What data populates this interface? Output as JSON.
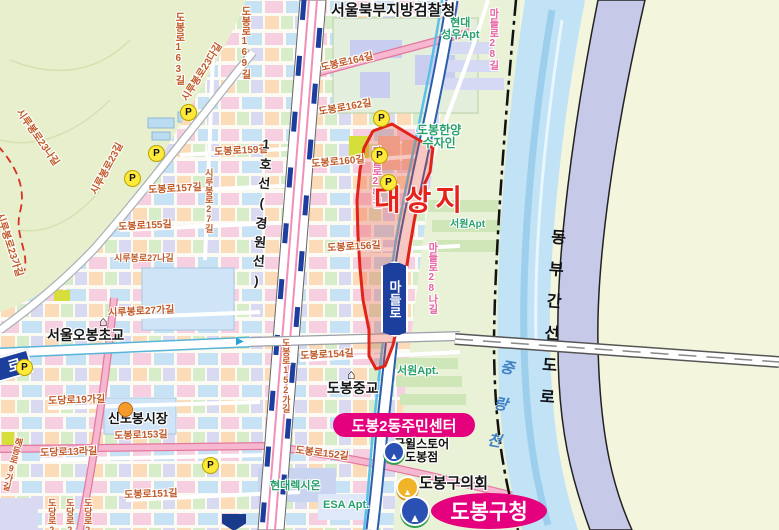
{
  "map_title": "도봉구 대상지 위치도",
  "badges": {
    "community_center": "도봉2동주민센터",
    "gu_office": "도봉구청",
    "madeulro": "마들로",
    "ro_partial": "로"
  },
  "colors": {
    "target_red": "#e5231b",
    "badge_magenta": "#e5007e",
    "road_badge_navy": "#1c3f9e",
    "street_text": "#c05a28",
    "pink_street_text": "#e7609f",
    "apt_text": "#27a06c",
    "river_blue": "#c2e3f6",
    "expressway_lavender": "#c6cae8",
    "railway_navy": "#1d3e9e",
    "railway_pink": "#f090b8",
    "parking_yellow": "#ffe93a",
    "land": "#f3f5dc",
    "mountain_green": "#e7efcd"
  },
  "labels": [
    {
      "name": "agency-label",
      "text": "서울북부지방검찰청",
      "x": 331,
      "y": 3,
      "cls": "poi",
      "s": 15
    },
    {
      "name": "apt-hyundai-seongwoo",
      "text": "현대\n성우Apt",
      "x": 441,
      "y": 18,
      "cls": "apt center",
      "s": 11
    },
    {
      "name": "street-madeulro28-top",
      "text": "마들로28길",
      "x": 486,
      "y": 8,
      "cls": "pstreet vert",
      "s": 10
    },
    {
      "name": "street-dobongro163",
      "text": "도봉로163길",
      "x": 172,
      "y": 12,
      "cls": "street vert",
      "s": 10
    },
    {
      "name": "street-dobongro169",
      "text": "도봉로169길",
      "x": 238,
      "y": 6,
      "cls": "street vert",
      "s": 10
    },
    {
      "name": "street-sirubongro23da",
      "text": "시루봉로23다길",
      "x": 181,
      "y": 98,
      "cls": "street",
      "s": 10,
      "rot": -58
    },
    {
      "name": "street-sirubongro23na",
      "text": "시루봉로23나길",
      "x": 22,
      "y": 108,
      "cls": "street",
      "s": 10,
      "rot": 55
    },
    {
      "name": "street-sirubongro23",
      "text": "시루봉로23길",
      "x": 90,
      "y": 192,
      "cls": "street",
      "s": 10,
      "rot": -62
    },
    {
      "name": "street-sirubongro23ga",
      "text": "시루봉로23가길",
      "x": 3,
      "y": 212,
      "cls": "street",
      "s": 10,
      "rot": 72
    },
    {
      "name": "street-dobongro164",
      "text": "도봉로164길",
      "x": 320,
      "y": 64,
      "cls": "street",
      "s": 10,
      "rot": -13
    },
    {
      "name": "street-dobongro162",
      "text": "도봉로162길",
      "x": 318,
      "y": 108,
      "cls": "street",
      "s": 10,
      "rot": -10
    },
    {
      "name": "street-dobongro160",
      "text": "도봉로160길",
      "x": 311,
      "y": 160,
      "cls": "street",
      "s": 10,
      "rot": -5
    },
    {
      "name": "street-dobongro159",
      "text": "도봉로159길",
      "x": 214,
      "y": 148,
      "cls": "street",
      "s": 10,
      "rot": -3
    },
    {
      "name": "street-dobongro157",
      "text": "도봉로157길",
      "x": 148,
      "y": 186,
      "cls": "street",
      "s": 10,
      "rot": -3
    },
    {
      "name": "street-sirubongro27",
      "text": "시루봉로27길",
      "x": 203,
      "y": 168,
      "cls": "street vert",
      "s": 9
    },
    {
      "name": "street-dobongro155",
      "text": "도봉로155길",
      "x": 118,
      "y": 223,
      "cls": "street",
      "s": 10,
      "rot": -3
    },
    {
      "name": "street-sirubongro27na",
      "text": "시루봉로27나길",
      "x": 114,
      "y": 254,
      "cls": "street",
      "s": 9
    },
    {
      "name": "street-dobongro156",
      "text": "도봉로156길",
      "x": 327,
      "y": 244,
      "cls": "street",
      "s": 10,
      "rot": -3
    },
    {
      "name": "street-sirubongro27ga",
      "text": "시루봉로27가길",
      "x": 108,
      "y": 309,
      "cls": "street",
      "s": 10,
      "rot": -3
    },
    {
      "name": "street-dobongro154",
      "text": "도봉로154길",
      "x": 300,
      "y": 352,
      "cls": "street",
      "s": 10,
      "rot": -3
    },
    {
      "name": "street-dobongro152ga",
      "text": "도봉로152가길",
      "x": 280,
      "y": 338,
      "cls": "street vert",
      "s": 9
    },
    {
      "name": "street-dobongro153",
      "text": "도봉로153길",
      "x": 114,
      "y": 432,
      "cls": "street",
      "s": 10,
      "rot": -2
    },
    {
      "name": "street-dodangro19ga",
      "text": "도당로19가길",
      "x": 48,
      "y": 397,
      "cls": "street",
      "s": 10,
      "rot": -2
    },
    {
      "name": "street-dodangro13ra",
      "text": "도당로13라길",
      "x": 40,
      "y": 449,
      "cls": "street",
      "s": 10,
      "rot": -2
    },
    {
      "name": "street-dobongro151",
      "text": "도봉로151길",
      "x": 124,
      "y": 491,
      "cls": "street",
      "s": 10,
      "rot": -2
    },
    {
      "name": "street-dobongro152",
      "text": "도봉로152길",
      "x": 296,
      "y": 446,
      "cls": "street",
      "s": 10,
      "rot": 7
    },
    {
      "name": "street-dodangro21",
      "text": "도당로21길",
      "x": 46,
      "y": 498,
      "cls": "street vert",
      "s": 9
    },
    {
      "name": "street-dodangro23",
      "text": "도당로23길",
      "x": 64,
      "y": 498,
      "cls": "street vert",
      "s": 9
    },
    {
      "name": "street-dodangro25",
      "text": "도당로25길",
      "x": 82,
      "y": 498,
      "cls": "street vert",
      "s": 9
    },
    {
      "name": "street-haedeungro9ga",
      "text": "해등로9가길",
      "x": 14,
      "y": 436,
      "cls": "street vert",
      "s": 9,
      "rot": 15
    },
    {
      "name": "street-madeulro28-inner",
      "text": "마들로28길",
      "x": 369,
      "y": 146,
      "cls": "pstreet vert",
      "s": 10
    },
    {
      "name": "street-madeulro28na",
      "text": "마들로28나길",
      "x": 425,
      "y": 242,
      "cls": "pstreet vert",
      "s": 10
    },
    {
      "name": "apt-hanyang-sujain",
      "text": "도봉한양\n수자인",
      "x": 417,
      "y": 124,
      "cls": "apt center",
      "s": 12
    },
    {
      "name": "apt-seowon-upper",
      "text": "서원Apt",
      "x": 450,
      "y": 220,
      "cls": "apt",
      "s": 10
    },
    {
      "name": "apt-seowon-lower",
      "text": "서원Apt.",
      "x": 397,
      "y": 366,
      "cls": "apt",
      "s": 11
    },
    {
      "name": "apt-hyundai-lexion",
      "text": "현대렉시온",
      "x": 270,
      "y": 481,
      "cls": "apt",
      "s": 11
    },
    {
      "name": "apt-esa",
      "text": "ESA Apt.",
      "x": 323,
      "y": 500,
      "cls": "apt",
      "s": 11
    },
    {
      "name": "school-obong-label",
      "text": "서울오봉초교",
      "x": 47,
      "y": 328,
      "cls": "poi",
      "s": 14
    },
    {
      "name": "school-dobong-middle-label",
      "text": "도봉중교",
      "x": 327,
      "y": 381,
      "cls": "poi",
      "s": 14
    },
    {
      "name": "market-sindobong-label",
      "text": "신도봉시장",
      "x": 108,
      "y": 412,
      "cls": "poi",
      "s": 13
    },
    {
      "name": "store-goodwill-label",
      "text": "굿윌스토어\n도봉점",
      "x": 394,
      "y": 438,
      "cls": "poi center",
      "s": 12
    },
    {
      "name": "council-label",
      "text": "도봉구의회",
      "x": 419,
      "y": 476,
      "cls": "poi",
      "s": 15
    },
    {
      "name": "target-site-label",
      "text": "대상지",
      "x": 374,
      "y": 186,
      "cls": "target",
      "s": 29,
      "sp": 4
    },
    {
      "name": "line1-railway-label",
      "text": "1호선(경원선)",
      "x": 259,
      "y": 136,
      "cls": "rail vert",
      "s": 13,
      "rot": 4,
      "sp": 6
    },
    {
      "name": "expressway-label",
      "text": "동부간선도로",
      "x": 548,
      "y": 228,
      "cls": "expy vert",
      "s": 16,
      "rot": 4,
      "sp": 16
    },
    {
      "name": "river-label",
      "text": "중랑천",
      "x": 499,
      "y": 358,
      "cls": "water vert",
      "s": 15,
      "rot": 10,
      "sp": 22
    }
  ],
  "icons": {
    "parking_letter": "P",
    "parking": [
      {
        "x": 180,
        "y": 104
      },
      {
        "x": 148,
        "y": 145
      },
      {
        "x": 124,
        "y": 170
      },
      {
        "x": 16,
        "y": 359
      },
      {
        "x": 202,
        "y": 457
      },
      {
        "x": 373,
        "y": 110
      },
      {
        "x": 371,
        "y": 147
      },
      {
        "x": 380,
        "y": 174
      }
    ],
    "schools": [
      {
        "x": 99,
        "y": 313
      },
      {
        "x": 347,
        "y": 366
      }
    ],
    "market": [
      {
        "x": 118,
        "y": 402
      }
    ],
    "gov_blue_small": [
      {
        "x": 383,
        "y": 441
      }
    ],
    "gov_yellow": [
      {
        "x": 396,
        "y": 476
      }
    ],
    "gov_blue_large": [
      {
        "x": 400,
        "y": 496
      }
    ],
    "station": [
      {
        "x": 222,
        "y": 514
      }
    ],
    "road_arrow": [
      {
        "x": 236,
        "y": 336
      }
    ]
  }
}
